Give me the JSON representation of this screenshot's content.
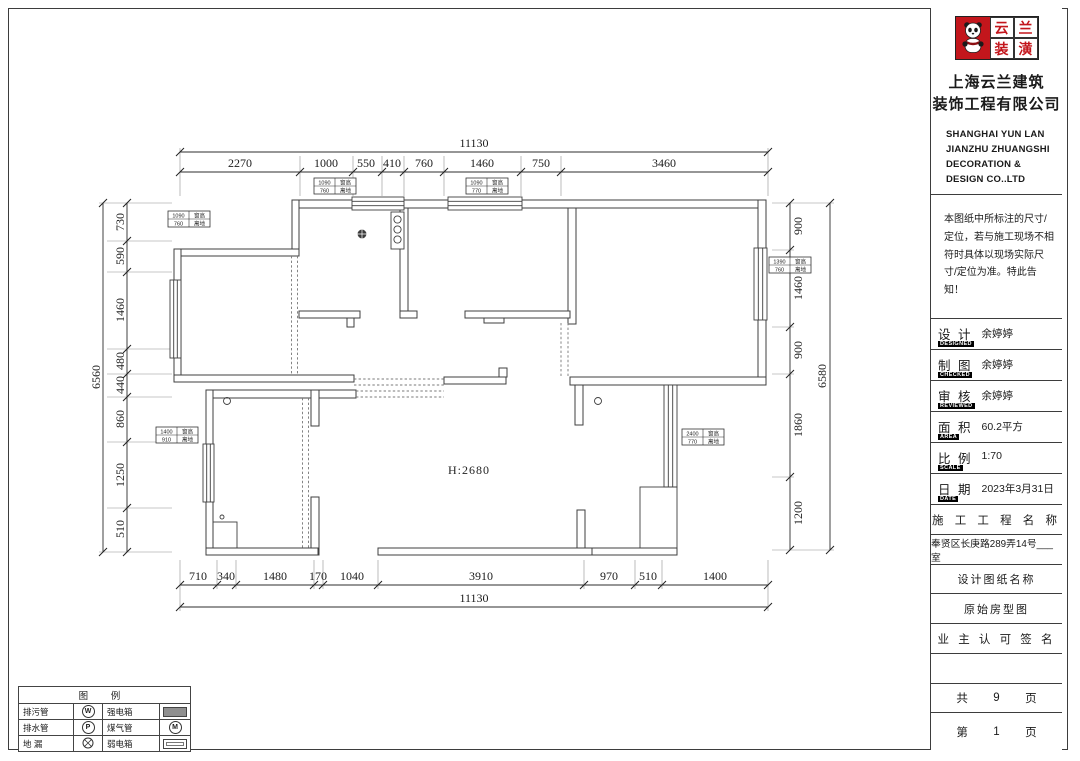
{
  "titleblock": {
    "logo": {
      "brand_char_1": "云",
      "brand_char_2": "兰",
      "brand_char_3": "装",
      "brand_char_4": "潢"
    },
    "company_cn_line1": "上海云兰建筑",
    "company_cn_line2": "装饰工程有限公司",
    "company_en_lines": [
      "SHANGHAI YUN LAN",
      "JIANZHU ZHUANGSHI",
      "DECORATION &",
      "DESIGN CO..LTD"
    ],
    "notice": "本图纸中所标注的尺寸/定位，若与施工现场不相符时具体以现场实际尺寸/定位为准。特此告知！",
    "fields": [
      {
        "label": "设 计",
        "sub": "DESIGNED",
        "value": "余婷婷"
      },
      {
        "label": "制 图",
        "sub": "CHECKED",
        "value": "余婷婷"
      },
      {
        "label": "审 核",
        "sub": "REVIEWED",
        "value": "余婷婷"
      },
      {
        "label": "面 积",
        "sub": "AREA",
        "value": "60.2平方"
      },
      {
        "label": "比 例",
        "sub": "SCALE",
        "value": "1:70"
      },
      {
        "label": "日 期",
        "sub": "DATE",
        "value": "2023年3月31日"
      }
    ],
    "project_header": "施 工 工 程 名 称",
    "project_address": "奉贤区长庚路289弄14号___室",
    "drawing_header": "设计图纸名称",
    "drawing_name": "原始房型图",
    "owner_sign": "业 主 认 可 签 名",
    "pages_total_label": "共",
    "pages_total": "9",
    "pages_unit": "页",
    "page_label": "第",
    "page_number": "1",
    "page_unit": "页"
  },
  "plan": {
    "height_label": "H:2680",
    "dims": {
      "top_total": "11130",
      "top": [
        "2270",
        "1000",
        "550",
        "410",
        "760",
        "1460",
        "750",
        "3460"
      ],
      "bottom": [
        "710",
        "340",
        "1480",
        "170",
        "1040",
        "3910",
        "970",
        "510",
        "1400"
      ],
      "bottom_total": "11130",
      "left_total": "6560",
      "left": [
        "730",
        "590",
        "1460",
        "480",
        "440",
        "860",
        "1250",
        "510"
      ],
      "right": [
        "900",
        "1460",
        "900",
        "1860",
        "1200"
      ],
      "right_total": "6580"
    },
    "window_tags": [
      {
        "v1": "1090",
        "l1": "窗高",
        "v2": "760",
        "l2": "离地"
      },
      {
        "v1": "1090",
        "l1": "窗高",
        "v2": "770",
        "l2": "离地"
      },
      {
        "v1": "1090",
        "l1": "窗高",
        "v2": "760",
        "l2": "离地"
      },
      {
        "v1": "1400",
        "l1": "窗高",
        "v2": "910",
        "l2": "离地"
      },
      {
        "v1": "1390",
        "l1": "窗高",
        "v2": "760",
        "l2": "离地"
      },
      {
        "v1": "2400",
        "l1": "窗高",
        "v2": "770",
        "l2": "离地"
      }
    ]
  },
  "legend": {
    "title": "图 例",
    "rows": [
      {
        "name1": "排污管",
        "sym1": "W",
        "name2": "强电箱"
      },
      {
        "name1": "排水管",
        "sym1": "P",
        "name2": "煤气管",
        "sym2": "M"
      },
      {
        "name1": "地 漏",
        "name2": "弱电箱"
      }
    ]
  }
}
